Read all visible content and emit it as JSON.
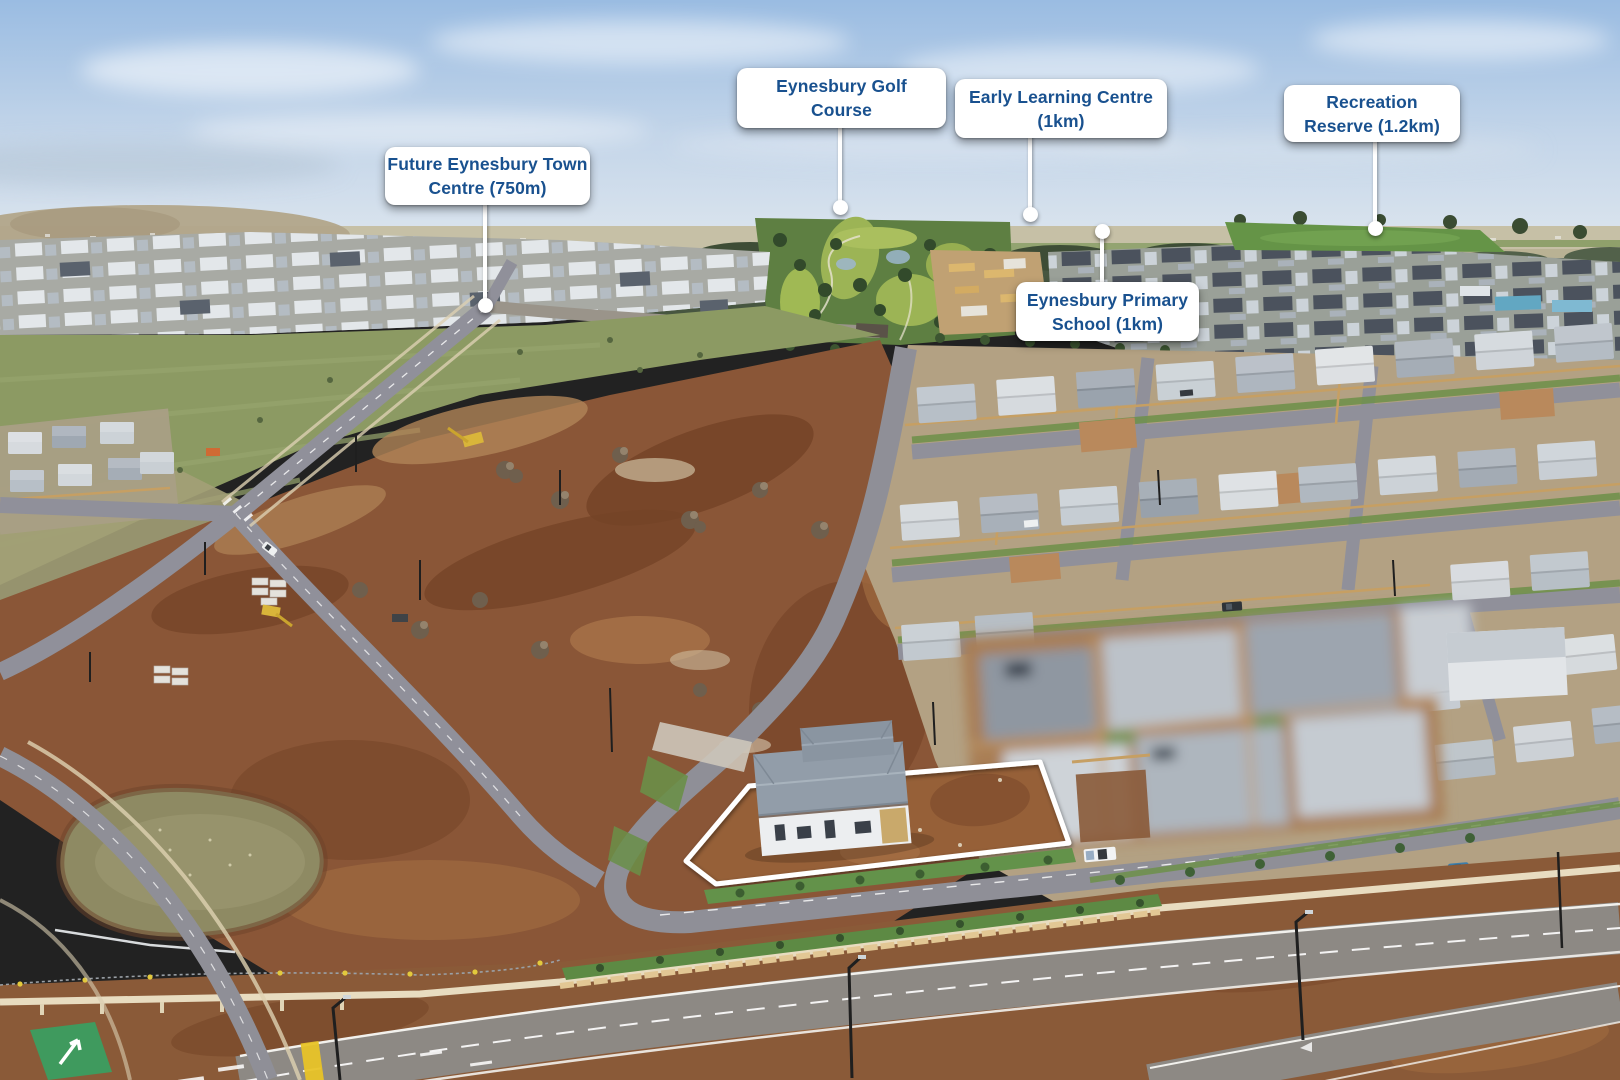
{
  "scene": {
    "type": "aerial-drone-photo-with-location-callouts",
    "location_labels": [
      {
        "id": "future-town-centre",
        "text": "Future Eynesbury Town Centre (750m)",
        "lines": [
          "Future Eynesbury Town",
          "Centre (750m)"
        ]
      },
      {
        "id": "golf-course",
        "text": "Eynesbury Golf Course",
        "lines": [
          "Eynesbury Golf",
          "Course"
        ]
      },
      {
        "id": "early-learning-centre",
        "text": "Early Learning Centre (1km)",
        "lines": [
          "Early Learning Centre",
          "(1km)"
        ]
      },
      {
        "id": "primary-school",
        "text": "Eynesbury Primary School (1km)",
        "lines": [
          "Eynesbury Primary",
          "School (1km)"
        ]
      },
      {
        "id": "recreation-reserve",
        "text": "Recreation Reserve (1.2km)",
        "lines": [
          "Recreation",
          "Reserve (1.2km)"
        ]
      }
    ],
    "colors": {
      "label_background": "#ffffff",
      "label_text": "#19518f",
      "pointer": "#ffffff",
      "property_outline": "#ffffff"
    }
  }
}
